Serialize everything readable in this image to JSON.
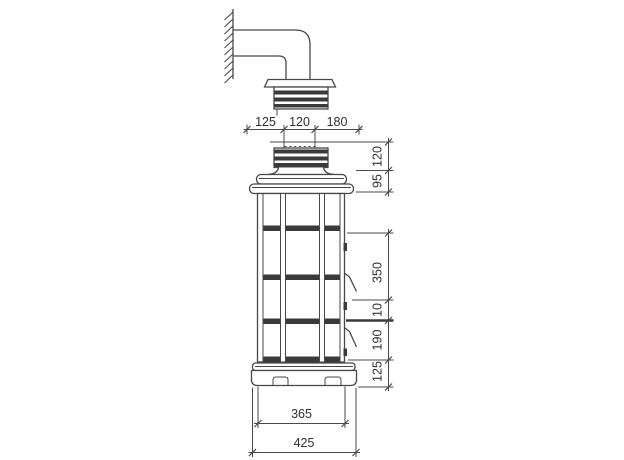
{
  "dims": {
    "top": [
      "125",
      "120",
      "180"
    ],
    "right_upper": [
      "120",
      "95"
    ],
    "right_lower": [
      "350",
      "10",
      "190",
      "125"
    ],
    "bottom_body_width": "365",
    "bottom_base_width": "425"
  },
  "colors": {
    "line": "#474747",
    "dark_fill": "#3a3a3a",
    "dimension_text": "#2e2e2e",
    "background": "#ffffff"
  }
}
